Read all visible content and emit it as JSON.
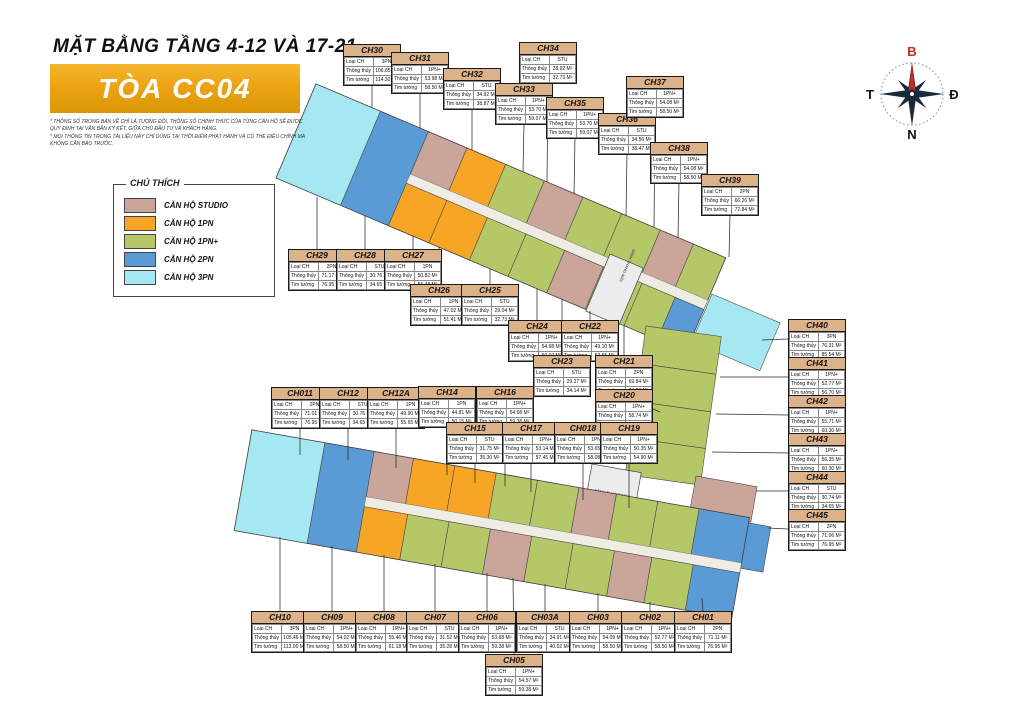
{
  "header": {
    "title": "MẶT BẰNG TẦNG 4-12 VÀ 17-21",
    "building": "TÒA CC04",
    "disclaimer1": "* THÔNG SỐ TRONG BẢN VẼ CHỈ LÀ TƯƠNG ĐỐI, THÔNG SỐ CHÍNH THỨC CỦA TỪNG CĂN HỘ SẼ ĐƯỢC QUY ĐỊNH TẠI VĂN BẢN KÝ KẾT, GIỮA CHỦ ĐẦU TƯ VÀ KHÁCH HÀNG.",
    "disclaimer2": "* MỌI THÔNG TIN TRONG TÀI LIỆU NÀY CHỈ DÙNG TẠI THỜI ĐIỂM PHÁT HÀNH VÀ CÓ THỂ ĐIỀU CHỈNH MÀ KHÔNG CẦN BÁO TRƯỚC."
  },
  "legend": {
    "title": "CHÚ THÍCH",
    "items": [
      {
        "label": "CĂN HỘ STUDIO",
        "color": "#c9a59a"
      },
      {
        "label": "CĂN HỘ 1PN",
        "color": "#f6a525"
      },
      {
        "label": "CĂN HỘ 1PN+",
        "color": "#b5c868"
      },
      {
        "label": "CĂN HỘ 2PN",
        "color": "#5b9bd5"
      },
      {
        "label": "CĂN HỘ 3PN",
        "color": "#a5e8f1"
      }
    ]
  },
  "compass": {
    "north": "B",
    "east": "Đ",
    "south": "N",
    "west": "T"
  },
  "plan": {
    "core_label": "SẢNH THANG MÁY"
  },
  "callout": {
    "rows": [
      "Loại CH",
      "Thông thủy",
      "Tim tường"
    ],
    "area_unit": "M²"
  },
  "units": [
    {
      "id": "CH30",
      "type": "3PN",
      "tt": "106.85",
      "tim": "114.30",
      "x": 343,
      "y": 44,
      "dir": "down",
      "tx": 372,
      "ty": 108
    },
    {
      "id": "CH31",
      "type": "1PN+",
      "tt": "53.98",
      "tim": "58.50",
      "x": 391,
      "y": 52,
      "dir": "down",
      "tx": 420,
      "ty": 128
    },
    {
      "id": "CH32",
      "type": "STU",
      "tt": "34.92",
      "tim": "38.87",
      "x": 443,
      "y": 68,
      "dir": "down",
      "tx": 472,
      "ty": 150
    },
    {
      "id": "CH33",
      "type": "1PN+",
      "tt": "53.70",
      "tim": "59.07",
      "x": 495,
      "y": 83,
      "dir": "down",
      "tx": 523,
      "ty": 172
    },
    {
      "id": "CH34",
      "type": "STU",
      "tt": "28.92",
      "tim": "32.73",
      "x": 519,
      "y": 42,
      "dir": "down",
      "tx": 547,
      "ty": 182
    },
    {
      "id": "CH35",
      "type": "1PN+",
      "tt": "53.70",
      "tim": "59.07",
      "x": 546,
      "y": 97,
      "dir": "down",
      "tx": 574,
      "ty": 193
    },
    {
      "id": "CH36",
      "type": "STU",
      "tt": "34.56",
      "tim": "38.47",
      "x": 598,
      "y": 113,
      "dir": "down",
      "tx": 626,
      "ty": 216
    },
    {
      "id": "CH37",
      "type": "1PN+",
      "tt": "54.08",
      "tim": "58.50",
      "x": 626,
      "y": 76,
      "dir": "down",
      "tx": 654,
      "ty": 227
    },
    {
      "id": "CH38",
      "type": "1PN+",
      "tt": "54.08",
      "tim": "58.50",
      "x": 650,
      "y": 142,
      "dir": "down",
      "tx": 678,
      "ty": 238
    },
    {
      "id": "CH39",
      "type": "2PN",
      "tt": "66.26",
      "tim": "72.84",
      "x": 701,
      "y": 174,
      "dir": "down",
      "tx": 729,
      "ty": 257
    },
    {
      "id": "CH40",
      "type": "3PN",
      "tt": "76.31",
      "tim": "85.54",
      "x": 788,
      "y": 319,
      "dir": "left",
      "tx": 762,
      "ty": 340
    },
    {
      "id": "CH41",
      "type": "1PN+",
      "tt": "52.77",
      "tim": "56.70",
      "x": 788,
      "y": 357,
      "dir": "left",
      "tx": 720,
      "ty": 377
    },
    {
      "id": "CH42",
      "type": "1PN+",
      "tt": "55.71",
      "tim": "60.30",
      "x": 788,
      "y": 395,
      "dir": "left",
      "tx": 716,
      "ty": 414
    },
    {
      "id": "CH43",
      "type": "1PN+",
      "tt": "56.35",
      "tim": "60.30",
      "x": 788,
      "y": 433,
      "dir": "left",
      "tx": 712,
      "ty": 452
    },
    {
      "id": "CH44",
      "type": "STU",
      "tt": "30.74",
      "tim": "34.65",
      "x": 788,
      "y": 471,
      "dir": "left",
      "tx": 756,
      "ty": 491
    },
    {
      "id": "CH45",
      "type": "2PN",
      "tt": "71.06",
      "tim": "76.95",
      "x": 788,
      "y": 509,
      "dir": "left",
      "tx": 768,
      "ty": 528
    },
    {
      "id": "CH29",
      "type": "2PN",
      "tt": "71.17",
      "tim": "76.95",
      "x": 288,
      "y": 249,
      "dir": "up",
      "tx": 317,
      "ty": 197
    },
    {
      "id": "CH28",
      "type": "STU",
      "tt": "30.76",
      "tim": "34.65",
      "x": 336,
      "y": 249,
      "dir": "up",
      "tx": 365,
      "ty": 216
    },
    {
      "id": "CH27",
      "type": "1PN",
      "tt": "50.82",
      "tim": "55.48",
      "x": 384,
      "y": 249,
      "dir": "up",
      "tx": 413,
      "ty": 236
    },
    {
      "id": "CH26",
      "type": "1PN",
      "tt": "47.02",
      "tim": "51.41",
      "x": 410,
      "y": 284,
      "dir": "up",
      "tx": 439,
      "ty": 247
    },
    {
      "id": "CH25",
      "type": "STU",
      "tt": "29.04",
      "tim": "32.73",
      "x": 461,
      "y": 284,
      "dir": "up",
      "tx": 490,
      "ty": 269
    },
    {
      "id": "CH24",
      "type": "1PN+",
      "tt": "54.98",
      "tim": "59.07",
      "x": 508,
      "y": 320,
      "dir": "up",
      "tx": 537,
      "ty": 289
    },
    {
      "id": "CH22",
      "type": "1PN+",
      "tt": "49.10",
      "tim": "53.55",
      "x": 561,
      "y": 320,
      "dir": "up",
      "tx": 590,
      "ty": 311
    },
    {
      "id": "CH23",
      "type": "STU",
      "tt": "29.27",
      "tim": "34.14",
      "x": 533,
      "y": 355,
      "dir": "up",
      "tx": 562,
      "ty": 299
    },
    {
      "id": "CH21",
      "type": "2PN",
      "tt": "69.84",
      "tim": "74.82",
      "x": 595,
      "y": 355,
      "dir": "up",
      "tx": 624,
      "ty": 326
    },
    {
      "id": "CH20",
      "type": "1PN+",
      "tt": "58.74",
      "tim": "66.30",
      "x": 595,
      "y": 389,
      "dir": "right",
      "tx": 660,
      "ty": 412
    },
    {
      "id": "CH011",
      "type": "2PN",
      "tt": "71.01",
      "tim": "76.95",
      "x": 271,
      "y": 387,
      "dir": "down",
      "tx": 300,
      "ty": 455
    },
    {
      "id": "CH12",
      "type": "STU",
      "tt": "30.76",
      "tim": "34.65",
      "x": 319,
      "y": 387,
      "dir": "down",
      "tx": 348,
      "ty": 460
    },
    {
      "id": "CH12A",
      "type": "1PN",
      "tt": "49.90",
      "tim": "55.65",
      "x": 367,
      "y": 387,
      "dir": "down",
      "tx": 396,
      "ty": 468
    },
    {
      "id": "CH14",
      "type": "1PN",
      "tt": "44.81",
      "tim": "50.15",
      "x": 418,
      "y": 386,
      "dir": "down",
      "tx": 447,
      "ty": 475
    },
    {
      "id": "CH16",
      "type": "1PN+",
      "tt": "54.68",
      "tim": "59.38",
      "x": 476,
      "y": 386,
      "dir": "down",
      "tx": 505,
      "ty": 486
    },
    {
      "id": "CH15",
      "type": "STU",
      "tt": "31.75",
      "tim": "35.30",
      "x": 446,
      "y": 422,
      "dir": "down",
      "tx": 475,
      "ty": 483
    },
    {
      "id": "CH17",
      "type": "1PN+",
      "tt": "53.14",
      "tim": "57.45",
      "x": 502,
      "y": 422,
      "dir": "down",
      "tx": 531,
      "ty": 492
    },
    {
      "id": "CH018",
      "type": "1PN+",
      "tt": "53.65",
      "tim": "58.08",
      "x": 554,
      "y": 422,
      "dir": "down",
      "tx": 583,
      "ty": 500
    },
    {
      "id": "CH19",
      "type": "1PN+",
      "tt": "50.35",
      "tim": "54.90",
      "x": 600,
      "y": 422,
      "dir": "down",
      "tx": 629,
      "ty": 508
    },
    {
      "id": "CH10",
      "type": "3PN",
      "tt": "105.46",
      "tim": "113.00",
      "x": 251,
      "y": 611,
      "dir": "up",
      "tx": 280,
      "ty": 537
    },
    {
      "id": "CH09",
      "type": "1PN+",
      "tt": "54.02",
      "tim": "58.50",
      "x": 303,
      "y": 611,
      "dir": "up",
      "tx": 332,
      "ty": 546
    },
    {
      "id": "CH08",
      "type": "1PN+",
      "tt": "55.46",
      "tim": "61.18",
      "x": 355,
      "y": 611,
      "dir": "up",
      "tx": 384,
      "ty": 555
    },
    {
      "id": "CH07",
      "type": "STU",
      "tt": "31.52",
      "tim": "35.28",
      "x": 406,
      "y": 611,
      "dir": "up",
      "tx": 435,
      "ty": 564
    },
    {
      "id": "CH06",
      "type": "1PN+",
      "tt": "53.68",
      "tim": "59.38",
      "x": 458,
      "y": 611,
      "dir": "up",
      "tx": 487,
      "ty": 573
    },
    {
      "id": "CH03A",
      "type": "STU",
      "tt": "34.91",
      "tim": "40.02",
      "x": 516,
      "y": 611,
      "dir": "up",
      "tx": 545,
      "ty": 584
    },
    {
      "id": "CH03",
      "type": "1PN+",
      "tt": "54.09",
      "tim": "58.50",
      "x": 569,
      "y": 611,
      "dir": "up",
      "tx": 598,
      "ty": 593
    },
    {
      "id": "CH02",
      "type": "1PN+",
      "tt": "52.77",
      "tim": "58.50",
      "x": 621,
      "y": 611,
      "dir": "up",
      "tx": 650,
      "ty": 602
    },
    {
      "id": "CH01",
      "type": "2PN",
      "tt": "71.11",
      "tim": "76.95",
      "x": 674,
      "y": 611,
      "dir": "up",
      "tx": 702,
      "ty": 598
    },
    {
      "id": "CH05",
      "type": "1PN+",
      "tt": "54.57",
      "tim": "59.38",
      "x": 485,
      "y": 654,
      "dir": "up",
      "tx": 513,
      "ty": 578
    }
  ]
}
